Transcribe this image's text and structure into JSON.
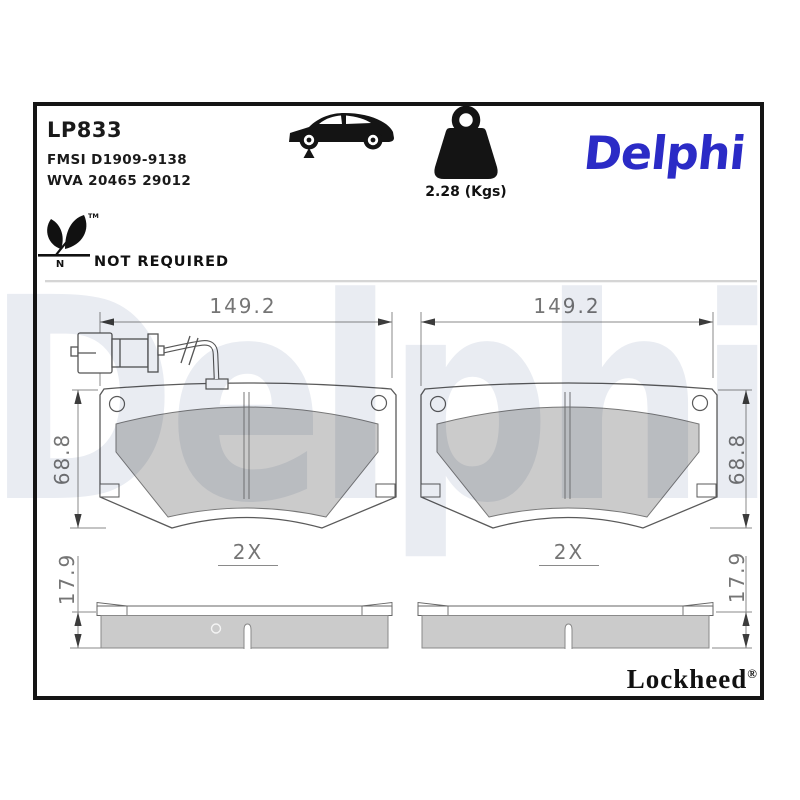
{
  "header": {
    "part_number": "LP833",
    "fmsi": "FMSI D1909-9138",
    "wva": "WVA 20465 29012",
    "weight_label": "2.28 (Kgs)",
    "brand_logo": "Delphi",
    "icons": {
      "vehicle": "car-side-silhouette",
      "weight": "kettlebell-weight"
    }
  },
  "compliance": {
    "status_label": "NOT REQUIRED",
    "leaf_mark_letter": "N",
    "leaf_mark_tm": "TM",
    "icon": "copper-free-leaf-mark"
  },
  "drawings": {
    "left_pad": {
      "width_mm": "149.2",
      "height_mm": "68.8",
      "thickness_mm": "17.9",
      "quantity_label": "2X",
      "has_wear_sensor": true
    },
    "right_pad": {
      "width_mm": "149.2",
      "height_mm": "68.8",
      "thickness_mm": "17.9",
      "quantity_label": "2X",
      "has_wear_sensor": false
    }
  },
  "footer": {
    "brand": "Lockheed",
    "registered_mark": "®"
  },
  "watermark": {
    "text": "Delphi",
    "color": "#E9ECF2"
  },
  "colors": {
    "brand_blue": "#2B2BC6",
    "friction_gray": "#CBCBCB",
    "outline_gray": "#5a5a5a",
    "dim_gray": "#757575",
    "frame_black": "#151515",
    "watermark_gray": "#E9ECF2"
  }
}
